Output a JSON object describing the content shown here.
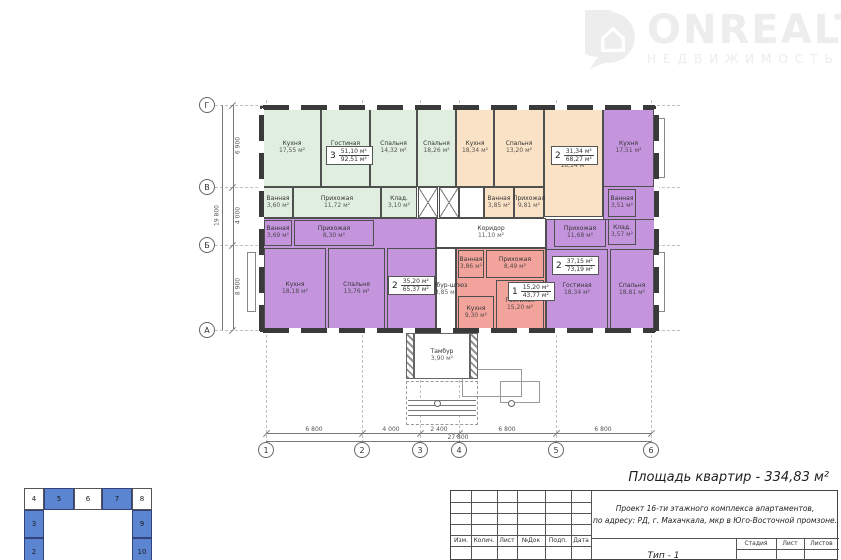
{
  "logo": {
    "brand": "ONREALT",
    "subtitle": "НЕДВИЖИМОСТЬ"
  },
  "summary": {
    "apartments_area": "Площадь квартир - 334,83 м²"
  },
  "plan": {
    "apartments": [
      {
        "color": "#dfeede",
        "stamp": {
          "count": "3",
          "living": "51,10 м²",
          "total": "92,51 м²"
        },
        "rooms": [
          {
            "name": "Кухня",
            "area": "17,55 м²"
          },
          {
            "name": "Гостиная",
            "area": "18,52 м²"
          },
          {
            "name": "Спальня",
            "area": "14,32 м²"
          },
          {
            "name": "Спальня",
            "area": "18,26 м²"
          },
          {
            "name": "Ванная",
            "area": "3,60 м²"
          },
          {
            "name": "Прихожая",
            "area": "11,72 м²"
          },
          {
            "name": "Клад.",
            "area": "3,10 м²"
          }
        ]
      },
      {
        "color": "#f9e2c6",
        "stamp": {
          "count": "2",
          "living": "31,34 м²",
          "total": "68,27 м²"
        },
        "rooms": [
          {
            "name": "Кухня",
            "area": "18,34 м²"
          },
          {
            "name": "Спальня",
            "area": "13,20 м²"
          },
          {
            "name": "Гостиная",
            "area": "18,14 м²"
          },
          {
            "name": "Ванная",
            "area": "3,85 м²"
          },
          {
            "name": "Прихожая",
            "area": "9,81 м²"
          },
          {
            "name": "Клад.",
            "area": "3,79 м²"
          }
        ]
      },
      {
        "color": "#c495dd",
        "stamp": {
          "count": "2",
          "living": "37,15 м²",
          "total": "73,19 м²"
        },
        "rooms": [
          {
            "name": "Кухня",
            "area": "17,51 м²"
          },
          {
            "name": "Ванная",
            "area": "3,51 м²"
          },
          {
            "name": "Клад.",
            "area": "3,57 м²"
          },
          {
            "name": "Прихожая",
            "area": "11,68 м²"
          },
          {
            "name": "Гостиная",
            "area": "18,34 м²"
          },
          {
            "name": "Спальня",
            "area": "18,81 м²"
          }
        ]
      },
      {
        "color": "#c495dd",
        "stamp": {
          "count": "2",
          "living": "35,20 м²",
          "total": "65,37 м²"
        },
        "rooms": [
          {
            "name": "Ванная",
            "area": "3,69 м²"
          },
          {
            "name": "Прихожая",
            "area": "8,30 м²"
          },
          {
            "name": "Кухня",
            "area": "18,18 м²"
          },
          {
            "name": "Спальня",
            "area": "13,76 м²"
          },
          {
            "name": "Гостиная",
            "area": "21,44 м²"
          }
        ]
      },
      {
        "color": "#f2a49c",
        "stamp": {
          "count": "1",
          "living": "15,20 м²",
          "total": "43,77 м²"
        },
        "rooms": [
          {
            "name": "Ванная",
            "area": "3,86 м²"
          },
          {
            "name": "Прихожая",
            "area": "8,49 м²"
          },
          {
            "name": "Кухня",
            "area": "9,30 м²"
          },
          {
            "name": "Гостиная",
            "area": "15,20 м²"
          }
        ]
      }
    ],
    "core": {
      "corridor": {
        "name": "Коридор",
        "area": "11,10 м²"
      },
      "airlock": {
        "name": "Тамбур-шлюз",
        "area": "3,85 м²"
      },
      "vestibule": {
        "name": "Тамбур",
        "area": "3,90 м²"
      }
    }
  },
  "axes": {
    "vertical": [
      "Г",
      "В",
      "Б",
      "А"
    ],
    "horizontal": [
      "1",
      "2",
      "3",
      "4",
      "5",
      "6"
    ],
    "v_dims": [
      "6 900",
      "4 000",
      "8 900"
    ],
    "v_total": "19 800",
    "h_dims": [
      "6 800",
      "4 000",
      "2 400",
      "6 800",
      "6 800"
    ],
    "h_total": "27 800"
  },
  "titleblock": {
    "revision_headers": [
      "Изм.",
      "Колич.",
      "Лист",
      "№Док",
      "Подп.",
      "Дата"
    ],
    "project_line1": "Проект 16-ти этажного комплекса апартаментов,",
    "project_line2": "по адресу: РД, г. Махачкала, мкр в Юго-Восточной промзоне.",
    "stage_headers": [
      "Стадия",
      "Лист",
      "Листов"
    ],
    "sheet_name": "Тип - 1"
  },
  "keyplan": {
    "top": [
      "4",
      "5",
      "6",
      "7",
      "8"
    ],
    "left": [
      "3",
      "2"
    ],
    "right": [
      "9",
      "10"
    ],
    "blue": "#5b84d1"
  }
}
